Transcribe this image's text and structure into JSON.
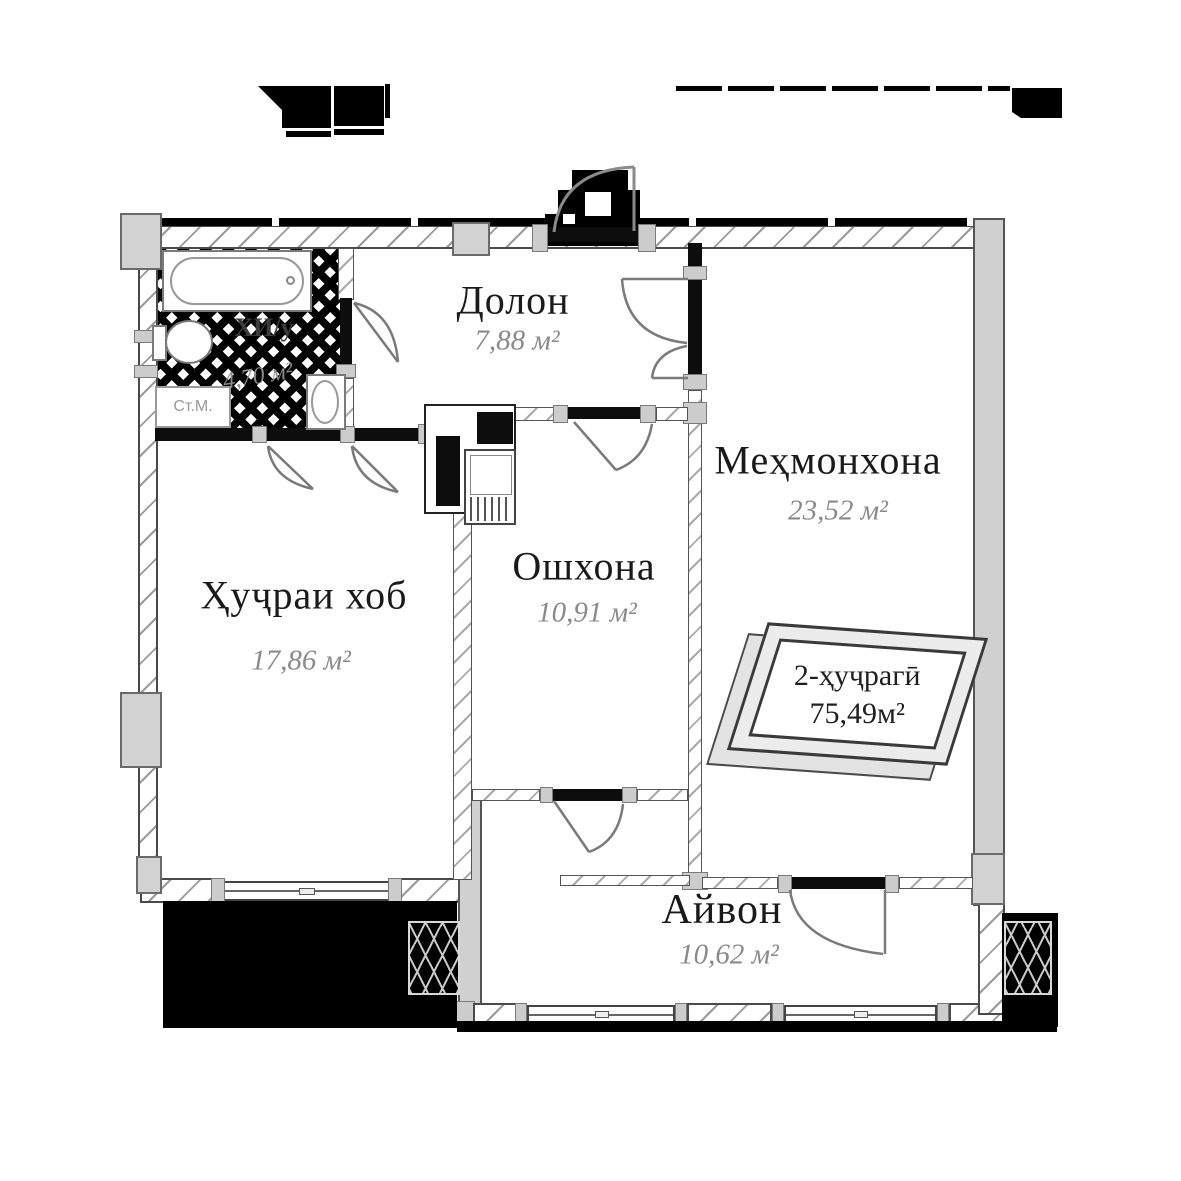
{
  "rooms": [
    {
      "name": "Долон",
      "area": "7,88 м²"
    },
    {
      "name": "Меҳмонхона",
      "area": "23,52 м²"
    },
    {
      "name": "Ошхона",
      "area": "10,91 м²"
    },
    {
      "name": "Ҳуҷраи хоб",
      "area": "17,86 м²"
    },
    {
      "name": "Айвон",
      "area": "10,62 м²"
    },
    {
      "name": "ХИ/у",
      "area": "4,70 м²"
    }
  ],
  "stamp": {
    "line1": "2-ҳуҷрагӣ",
    "line2": "75,49м²"
  },
  "fixtures": {
    "washing_machine": "Ст.М."
  },
  "colors": {
    "wall_outline": "#4a4a4a",
    "column_fill": "#d2d2d2",
    "partition_black": "#0d0d0d",
    "room_name_text": "#1a1a1a",
    "area_text": "#8a8a8a",
    "mask_black": "#000000",
    "door_arc": "#7a7a7a"
  }
}
